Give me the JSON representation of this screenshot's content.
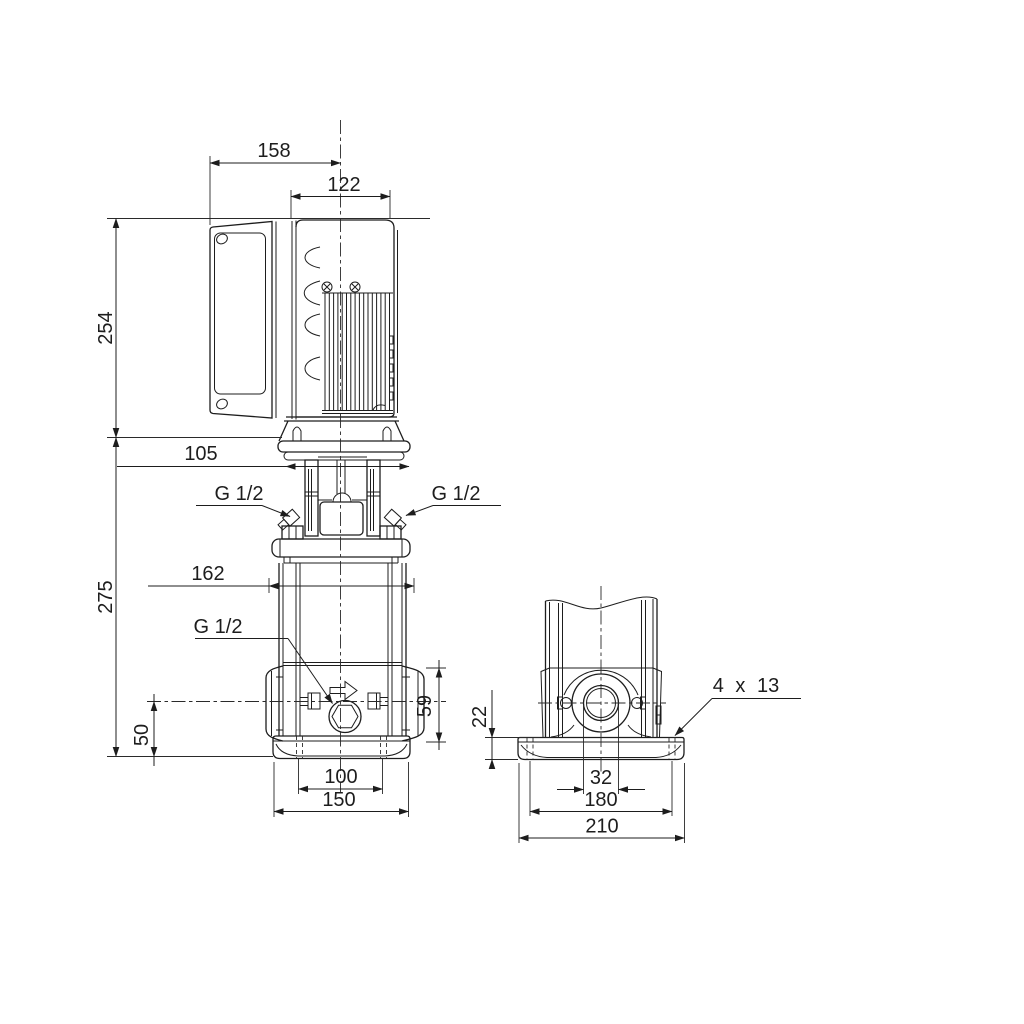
{
  "drawing": {
    "kind": "pump dimensional drawing",
    "colors": {
      "ink": "#1d1d1d",
      "background": "#ffffff"
    }
  },
  "dims": {
    "overall_width": "158",
    "motor_width": "122",
    "motor_height": "254",
    "head_offset": "105",
    "pump_height": "275",
    "head_width": "162",
    "gauge_port_left": "G 1/2",
    "gauge_port_right": "G 1/2",
    "drain_port": "G 1/2",
    "port_height": "59",
    "base_to_port": "50",
    "base_bolt_span_front": "100",
    "base_width_front": "150",
    "base_plate_height": "22",
    "port_diameter": "32",
    "base_bolt_span_side": "180",
    "base_width_side": "210",
    "base_hole_note": "4 x 13"
  }
}
